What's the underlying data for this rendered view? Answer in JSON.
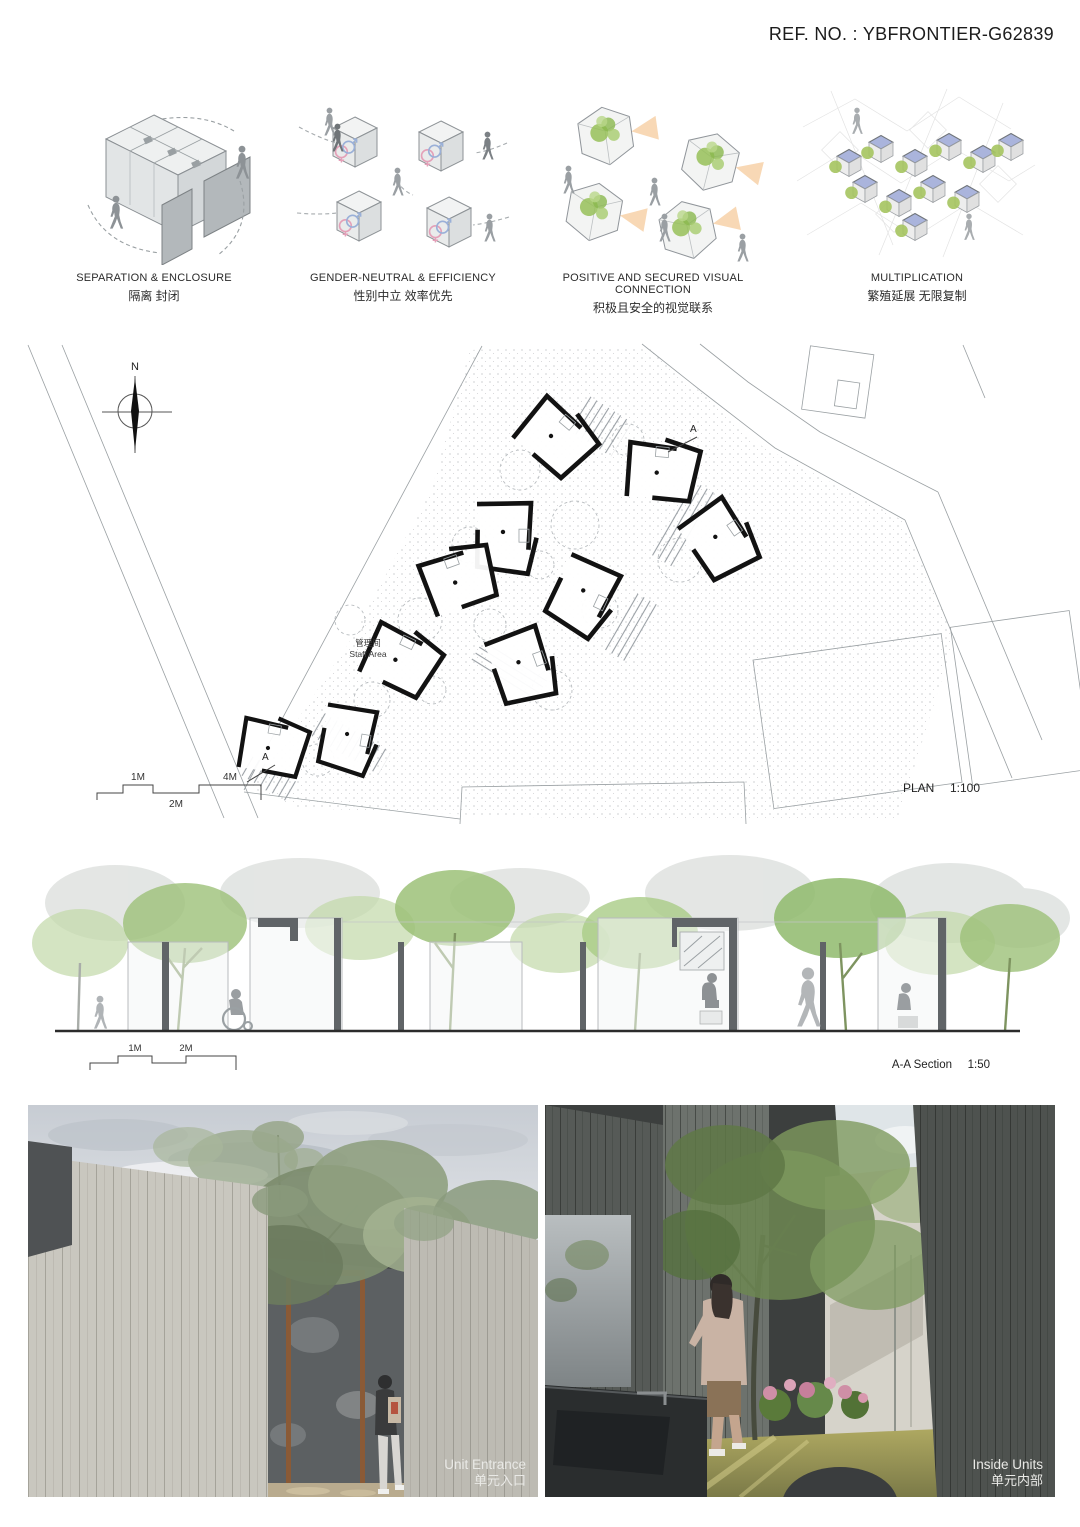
{
  "header": {
    "ref_no": "REF. NO. : YBFRONTIER-G62839"
  },
  "concepts": [
    {
      "title": "SEPARATION & ENCLOSURE",
      "subtitle": "隔离 封闭"
    },
    {
      "title": "GENDER-NEUTRAL & EFFICIENCY",
      "subtitle": "性别中立 效率优先"
    },
    {
      "title": "POSITIVE AND SECURED VISUAL CONNECTION",
      "subtitle": "积极且安全的视觉联系"
    },
    {
      "title": "MULTIPLICATION",
      "subtitle": "繁殖延展 无限复制"
    }
  ],
  "plan": {
    "north_label": "N",
    "staff_area_cn": "管理间",
    "staff_area_en": "Staff Area",
    "marker_a": "A",
    "scale_1m": "1M",
    "scale_2m": "2M",
    "scale_4m": "4M",
    "label": "PLAN",
    "scale": "1:100"
  },
  "section": {
    "label": "A-A Section",
    "scale": "1:50",
    "scale_1m": "1M",
    "scale_2m": "2M"
  },
  "renders": [
    {
      "title": "Unit Entrance",
      "subtitle": "单元入口"
    },
    {
      "title": "Inside Units",
      "subtitle": "单元内部"
    }
  ],
  "colors": {
    "accent_green": "#9ec47e",
    "roof_blue": "#aab4dc",
    "female_pink": "#e4a0b8",
    "male_blue": "#9ab0d8",
    "wall_black": "#121212",
    "corten": "#8a5a36"
  }
}
